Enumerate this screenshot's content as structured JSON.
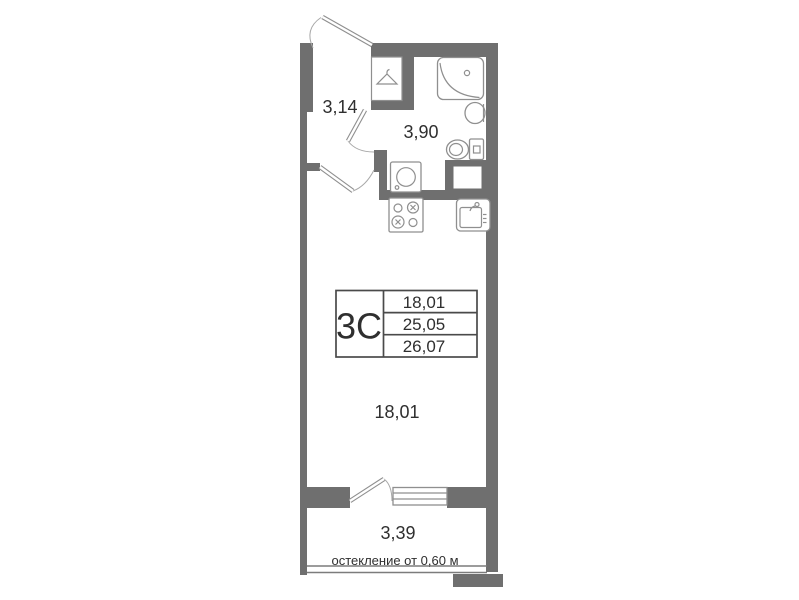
{
  "floorplan": {
    "stamp": {
      "type_label": "3С",
      "rows": [
        "18,01",
        "25,05",
        "26,07"
      ]
    },
    "labels": {
      "hallway_area": "3,14",
      "bathroom_area": "3,90",
      "room_area": "18,01",
      "balcony_area": "3,39",
      "glazing_note": "остекление от 0,60 м"
    },
    "icons": {
      "wardrobe": "hanger-icon",
      "bathroom": [
        "bathtub-icon",
        "sink-icon",
        "toilet-icon",
        "washing-machine-icon"
      ],
      "kitchen": [
        "stove-icon",
        "kitchen-sink-icon"
      ],
      "openings": [
        "entrance-door-icon",
        "room-door-icon",
        "bathroom-door-icon",
        "balcony-door-icon",
        "balcony-window-icon"
      ]
    },
    "colors": {
      "wall": "#6f6f6f",
      "fixture_stroke": "#8f8f8f",
      "text": "#2f2f2f",
      "stamp_border": "#4a4a4a",
      "background": "#ffffff"
    }
  }
}
